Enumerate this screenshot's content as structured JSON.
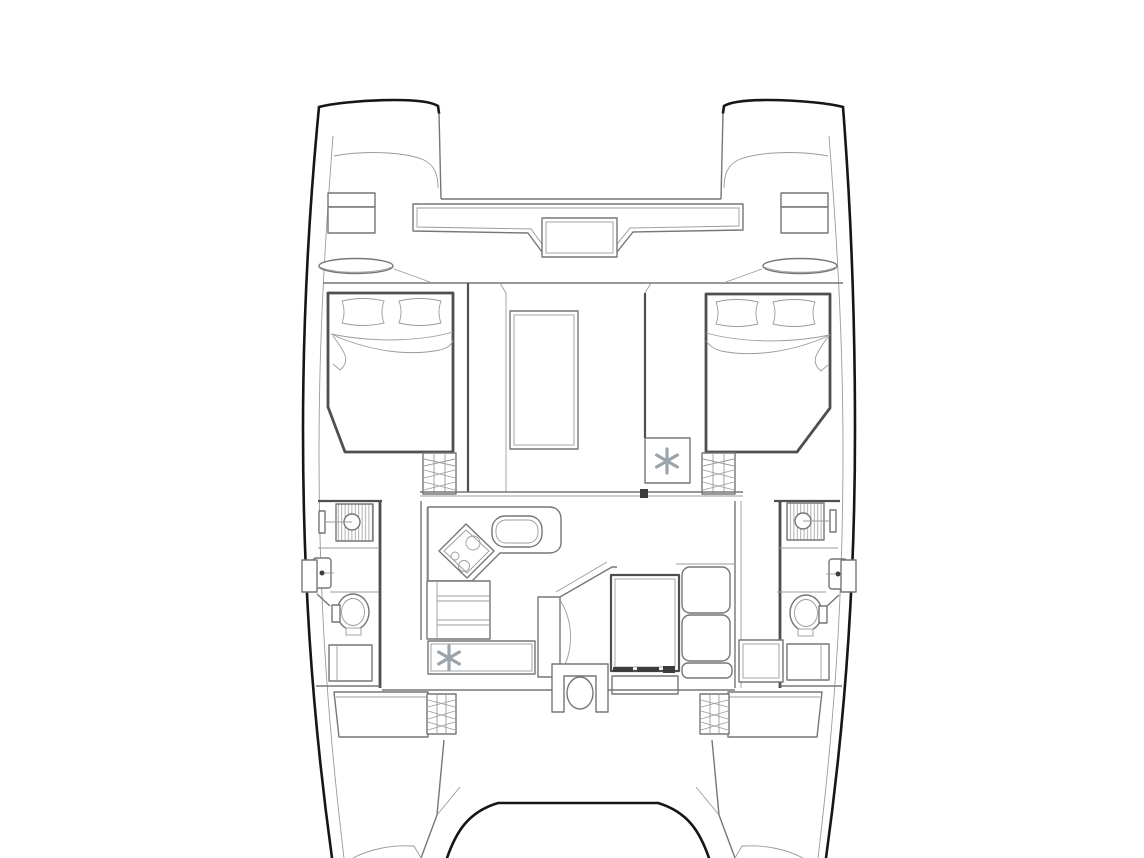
{
  "meta": {
    "title": "Catamaran deck plan — top view line drawing",
    "drawing_type": "architectural floor plan, no visible text labels"
  },
  "canvas": {
    "width": 1144,
    "height": 858,
    "background": "#ffffff"
  },
  "palette": {
    "hull_outline": "#161616",
    "wall": "#4f4f4f",
    "line": "#767676",
    "light_line": "#9b9b9b",
    "hatch": "#8f8f8f",
    "dark_fill": "#3d3d3d",
    "ac_symbol": "#9aa4ab"
  },
  "symbols": {
    "ac_snowflake": {
      "icon": "snowflake-icon",
      "glyph": "✻",
      "color": "#9aa4ab",
      "count": 2,
      "locations": [
        "saloon-port-sideboard",
        "starboard-forward-cabin-locker"
      ]
    }
  },
  "features": {
    "hulls": [
      "port-hull",
      "starboard-hull"
    ],
    "forward": [
      "port-bow-lockers",
      "starboard-bow-lockers",
      "foredeck-bench",
      "mast-step"
    ],
    "cabins": [
      "port-forward-double-berth",
      "starboard-forward-double-berth",
      "port-aft-berth",
      "starboard-aft-berth"
    ],
    "saloon": [
      "galley-l-counter",
      "three-burner-stove",
      "galley-sink",
      "skylight",
      "dinette-table",
      "l-settee",
      "chaise-bench",
      "companionway-seat",
      "sliding-door-track"
    ],
    "heads": [
      "port-shower",
      "port-washbasin",
      "port-toilet",
      "starboard-shower",
      "starboard-washbasin",
      "starboard-toilet"
    ],
    "stairs": [
      "port-forward-companionway-steps",
      "starboard-forward-companionway-steps",
      "port-aft-steps",
      "starboard-aft-steps"
    ],
    "aft": [
      "cockpit-coaming-curve",
      "port-transom-walkway",
      "starboard-transom-walkway"
    ]
  }
}
